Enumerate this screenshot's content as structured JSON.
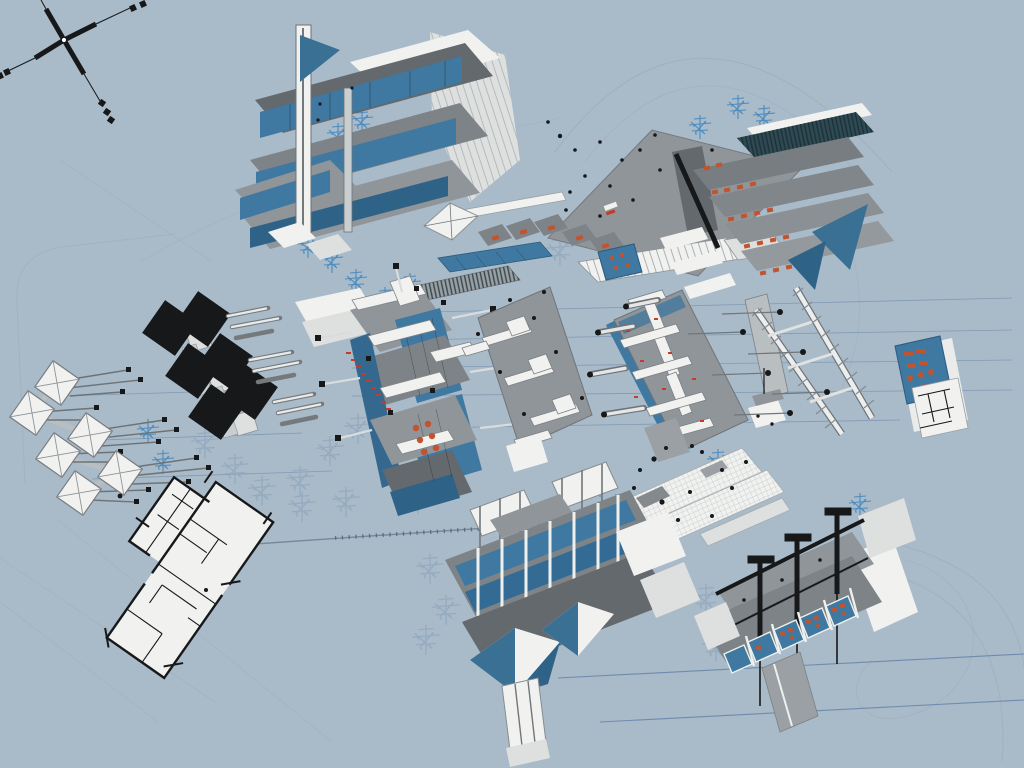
{
  "canvas": {
    "width": 1024,
    "height": 768,
    "background": "#a9bac8"
  },
  "palette": {
    "background": "#a9bac8",
    "slab_gray": "#8f9599",
    "deck_gray": "#7d8387",
    "dark_gray": "#63696d",
    "white": "#f1f2f0",
    "off_white": "#dde0df",
    "glazing_blue": "#3f78a1",
    "deep_blue": "#2f6287",
    "pyramid_blue": "#3a7093",
    "tree_blue": "#4386bd",
    "ghost_tree_blue": "#93aabf",
    "accent_orange": "#c2532f",
    "annotation_red": "#c23d28",
    "ink_black": "#17181a",
    "line_blue": "#5b7ca6",
    "curve_gray": "#9cabba",
    "hatch_teal": "#2e4a52"
  },
  "elements": [
    {
      "id": "compass",
      "label": "north-axis marker",
      "region": "top-left"
    },
    {
      "id": "building-tower",
      "label": "vertical tower axonometric",
      "region": "top-center-left"
    },
    {
      "id": "building-canopy-slab",
      "label": "large roof slab with figures",
      "region": "top-center"
    },
    {
      "id": "building-terraced",
      "label": "terraced auditorium block",
      "region": "top-right"
    },
    {
      "id": "black-panel-array",
      "label": "paired dark roof panels",
      "region": "middle-left"
    },
    {
      "id": "pavilion-chain",
      "label": "chained pyramid pavilions",
      "region": "far-left"
    },
    {
      "id": "building-central",
      "label": "central glazed building axonometric",
      "region": "center"
    },
    {
      "id": "flat-panel-center",
      "label": "tilted service-plan slab",
      "region": "center"
    },
    {
      "id": "flat-panel-right",
      "label": "tilted duct-plan slab",
      "region": "center-right"
    },
    {
      "id": "ladder-frame",
      "label": "double-rail ladder structure",
      "region": "right"
    },
    {
      "id": "detail-card",
      "label": "blue detail card with plan",
      "region": "far-right"
    },
    {
      "id": "grid-floor-plan",
      "label": "gridded white floor plan",
      "region": "center-bottom-right"
    },
    {
      "id": "floor-plan",
      "label": "black-line floor plan",
      "region": "bottom-left"
    },
    {
      "id": "building-south",
      "label": "long glazed block with blue pyramids",
      "region": "bottom-center"
    },
    {
      "id": "building-section",
      "label": "sectional block with black stacks",
      "region": "bottom-right"
    }
  ],
  "vegetation": {
    "bright": [
      [
        345,
        98
      ],
      [
        362,
        122
      ],
      [
        338,
        136
      ],
      [
        300,
        228
      ],
      [
        308,
        247
      ],
      [
        332,
        262
      ],
      [
        356,
        282
      ],
      [
        385,
        300
      ],
      [
        410,
        286
      ],
      [
        148,
        432
      ],
      [
        163,
        463
      ],
      [
        700,
        128
      ],
      [
        738,
        108
      ],
      [
        764,
        118
      ],
      [
        690,
        438
      ],
      [
        718,
        462
      ],
      [
        745,
        488
      ],
      [
        600,
        486
      ],
      [
        616,
        507
      ],
      [
        628,
        536
      ],
      [
        860,
        506
      ],
      [
        882,
        521
      ]
    ],
    "ghost": [
      [
        205,
        445
      ],
      [
        235,
        470
      ],
      [
        262,
        492
      ],
      [
        300,
        482
      ],
      [
        330,
        452
      ],
      [
        358,
        430
      ],
      [
        392,
        428
      ],
      [
        418,
        500
      ],
      [
        302,
        508
      ],
      [
        346,
        503
      ],
      [
        430,
        570
      ],
      [
        446,
        611
      ],
      [
        426,
        641
      ],
      [
        706,
        600
      ],
      [
        716,
        648
      ],
      [
        560,
        252
      ]
    ]
  }
}
